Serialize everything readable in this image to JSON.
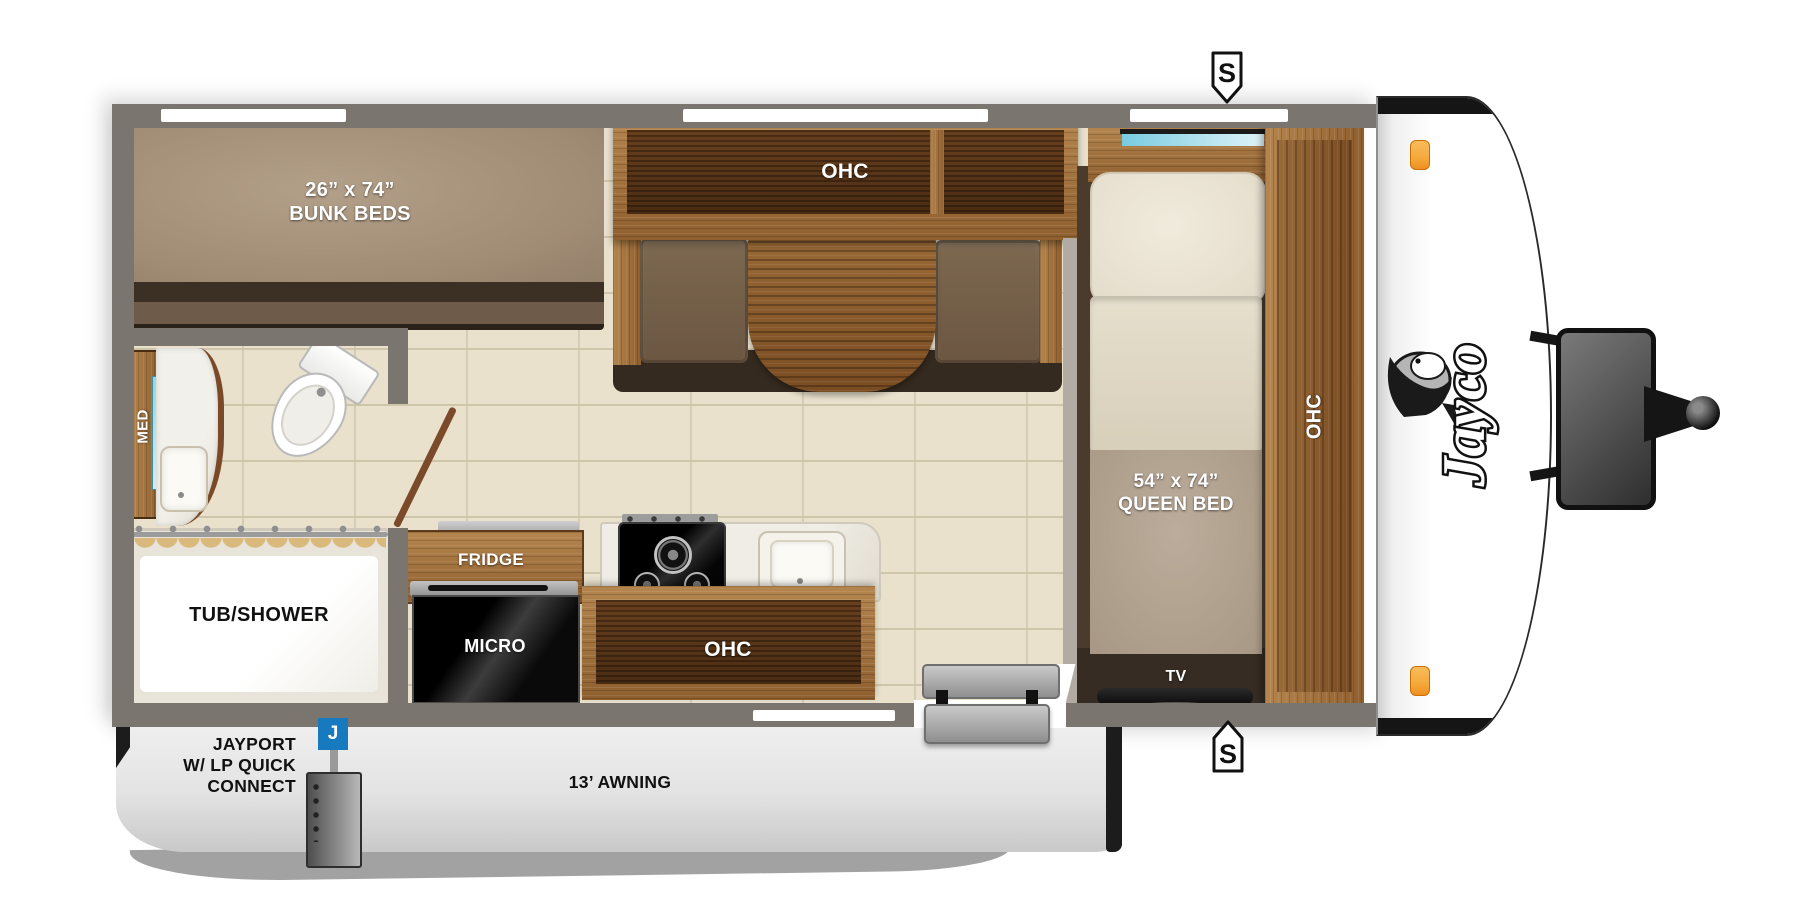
{
  "title": "Jayco travel trailer floor plan",
  "colors": {
    "wall": "#7b7570",
    "floor": "#e9e1cc",
    "floor_line": "#cfc5ab",
    "accent_blue": "#1779be",
    "clearance_orange": "#f5a93c",
    "window_cyan": "#79cbe0",
    "wood_light": "#a9743f",
    "wood_dark": "#5d3a1f",
    "cushion_brown": "#75604a"
  },
  "rooms": {
    "bunk": {
      "dim": "26” x 74”",
      "name": "BUNK BEDS"
    },
    "dinette": {
      "ohc": "OHC"
    },
    "bathroom": {
      "med": "MED",
      "tub": "TUB/SHOWER"
    },
    "kitchen": {
      "fridge": "FRIDGE",
      "micro": "MICRO",
      "ohc": "OHC"
    },
    "bedroom": {
      "dim": "54” x 74”",
      "name": "QUEEN BED",
      "tv": "TV",
      "ohc": "OHC"
    }
  },
  "exterior": {
    "jayport_line1": "JAYPORT",
    "jayport_line2": "W/ LP QUICK",
    "jayport_line3": "CONNECT",
    "awning": "13’ AWNING",
    "speaker_marker": "S",
    "jayport_marker": "J",
    "brand": "Jayco"
  }
}
